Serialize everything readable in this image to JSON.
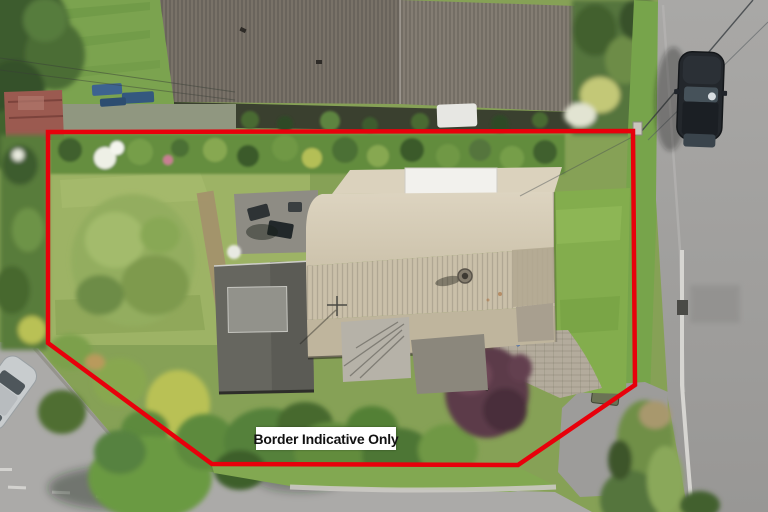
{
  "overlay": {
    "label": "Border Indicative Only",
    "border_color": "#e8000b",
    "border_points": "48,132 633,131 635,385 518,465 212,464 48,343",
    "label_background": "#ffffff",
    "label_text_color": "#111111"
  }
}
